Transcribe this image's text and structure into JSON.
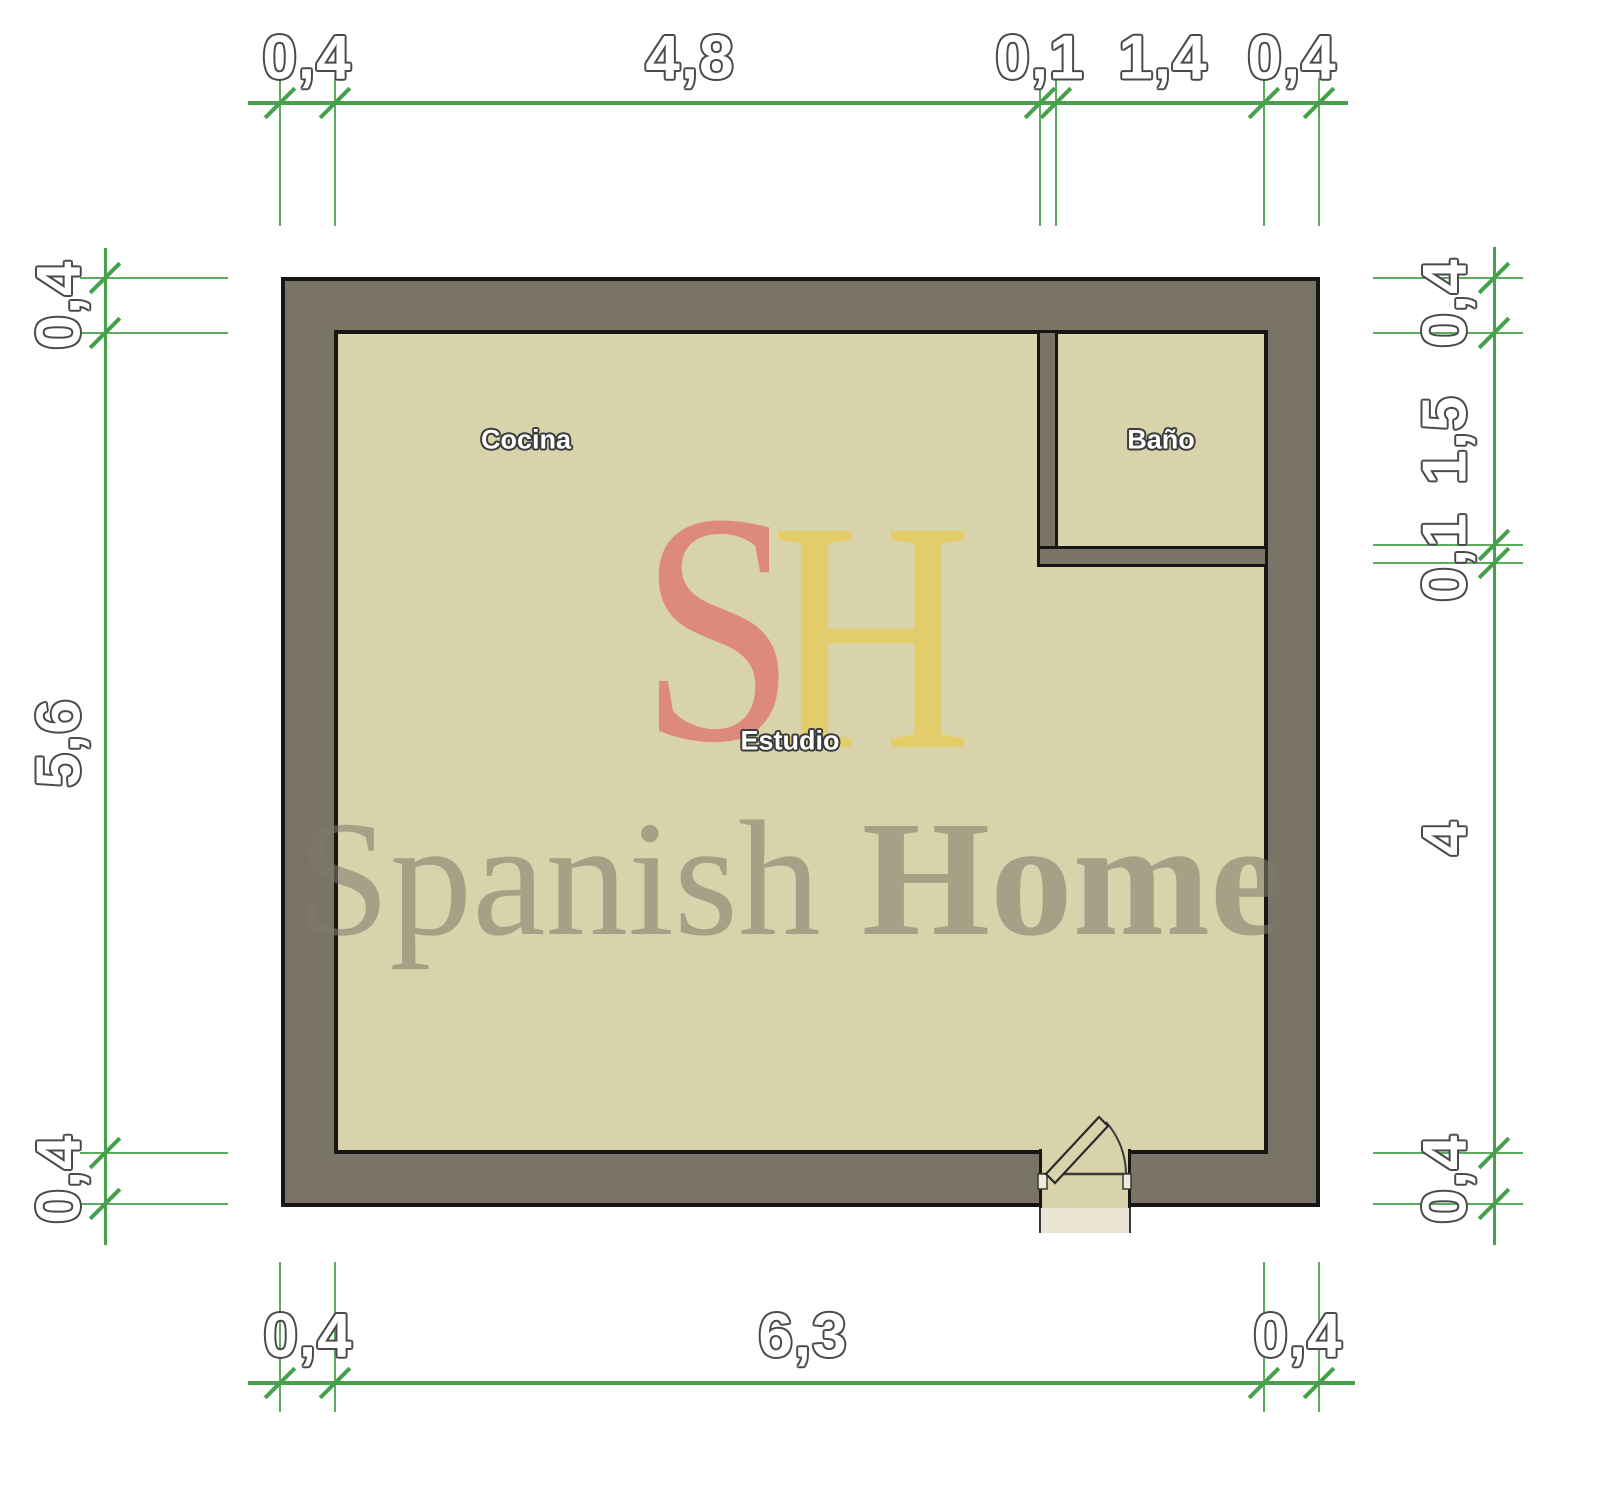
{
  "watermark": {
    "logo_letter_s": "S",
    "logo_letter_h": "H",
    "brand_word_1": "Spanish",
    "brand_word_2": "Home"
  },
  "rooms": {
    "kitchen_label": "Cocina",
    "studio_label": "Estudio",
    "bathroom_label": "Baño"
  },
  "dimensions": {
    "top": [
      "0,4",
      "4,8",
      "0,1",
      "1,4",
      "0,4"
    ],
    "bottom": [
      "0,4",
      "6,3",
      "0,4"
    ],
    "left": [
      "0,4",
      "5,6",
      "0,4"
    ],
    "right": [
      "0,4",
      "1,5",
      "0,1",
      "4",
      "0,4"
    ]
  },
  "colors": {
    "wall_fill": "#7a7466",
    "floor_fill": "#d8d3ab",
    "wall_outline": "#161616",
    "dimension_green": "#47a14c",
    "logo_s_color": "#dd8a7c",
    "logo_h_color": "#e3cd6a",
    "watermark_gray": "#807a6a"
  }
}
